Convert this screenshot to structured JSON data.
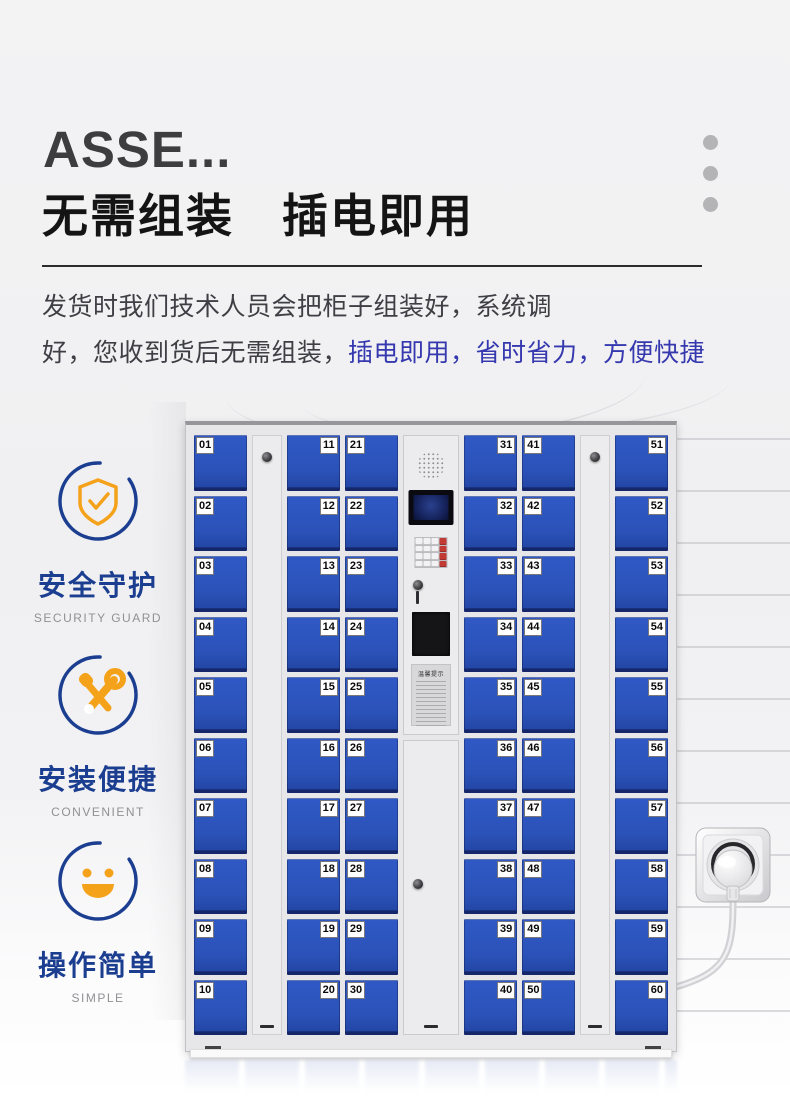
{
  "header": {
    "title_en": "ASSE...",
    "title_cn": "无需组装　插电即用",
    "desc_line1": "发货时我们技术人员会把柜子组装好，系统调",
    "desc_line2_prefix": "好，您收到货后无需组装，",
    "desc_line2_highlight": "插电即用，省时省力，方便快捷",
    "highlight_color": "#3538ae"
  },
  "features": [
    {
      "icon": "shield-check-icon",
      "label_cn": "安全守护",
      "label_en": "SECURITY GUARD"
    },
    {
      "icon": "tools-icon",
      "label_cn": "安装便捷",
      "label_en": "CONVENIENT"
    },
    {
      "icon": "smiley-icon",
      "label_cn": "操作简单",
      "label_en": "SIMPLE"
    }
  ],
  "cabinet": {
    "door_color": "#2d54bc",
    "frame_color": "#e7e7e9",
    "columns": [
      {
        "type": "doors",
        "label_side": "left",
        "numbers": [
          "01",
          "02",
          "03",
          "04",
          "05",
          "06",
          "07",
          "08",
          "09",
          "10"
        ]
      },
      {
        "type": "panel"
      },
      {
        "type": "doors",
        "label_side": "right",
        "numbers": [
          "11",
          "12",
          "13",
          "14",
          "15",
          "16",
          "17",
          "18",
          "19",
          "20"
        ]
      },
      {
        "type": "doors",
        "label_side": "left",
        "numbers": [
          "21",
          "22",
          "23",
          "24",
          "25",
          "26",
          "27",
          "28",
          "29",
          "30"
        ]
      },
      {
        "type": "control"
      },
      {
        "type": "doors",
        "label_side": "right",
        "numbers": [
          "31",
          "32",
          "33",
          "34",
          "35",
          "36",
          "37",
          "38",
          "39",
          "40"
        ]
      },
      {
        "type": "doors",
        "label_side": "left",
        "numbers": [
          "41",
          "42",
          "43",
          "44",
          "45",
          "46",
          "47",
          "48",
          "49",
          "50"
        ]
      },
      {
        "type": "panel"
      },
      {
        "type": "doors",
        "label_side": "right",
        "numbers": [
          "51",
          "52",
          "53",
          "54",
          "55",
          "56",
          "57",
          "58",
          "59",
          "60"
        ]
      }
    ],
    "control": {
      "sticker_title": "温馨提示"
    }
  },
  "colors": {
    "feature_blue": "#1c3e90",
    "feature_orange": "#f5a21b",
    "keypad_red": "#c23a34"
  }
}
